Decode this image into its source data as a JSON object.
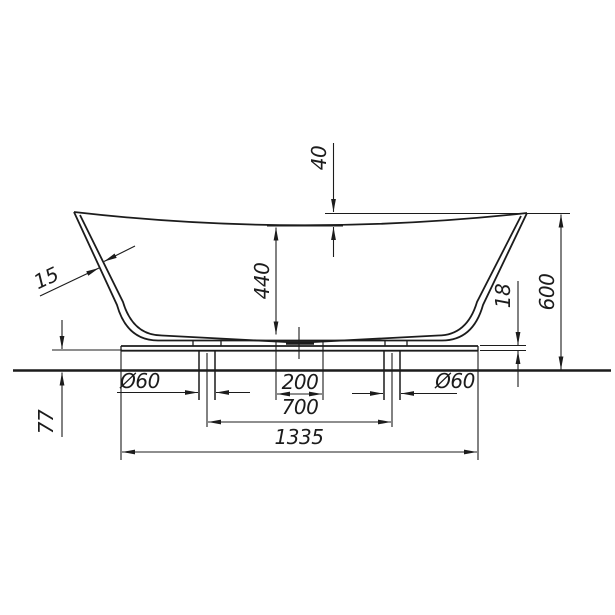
{
  "drawing": {
    "background": "#ffffff",
    "line_color": "#1c1c1c",
    "labels": {
      "rim_drop": "40",
      "inner_depth": "440",
      "wall_thickness": "15",
      "plate_thickness": "18",
      "total_height": "600",
      "floor_clearance": "77",
      "pipe_dia_left": "Ø60",
      "pipe_dia_right": "Ø60",
      "drain_slot_width": "200",
      "pipe_spacing": "700",
      "base_length": "1335"
    }
  }
}
